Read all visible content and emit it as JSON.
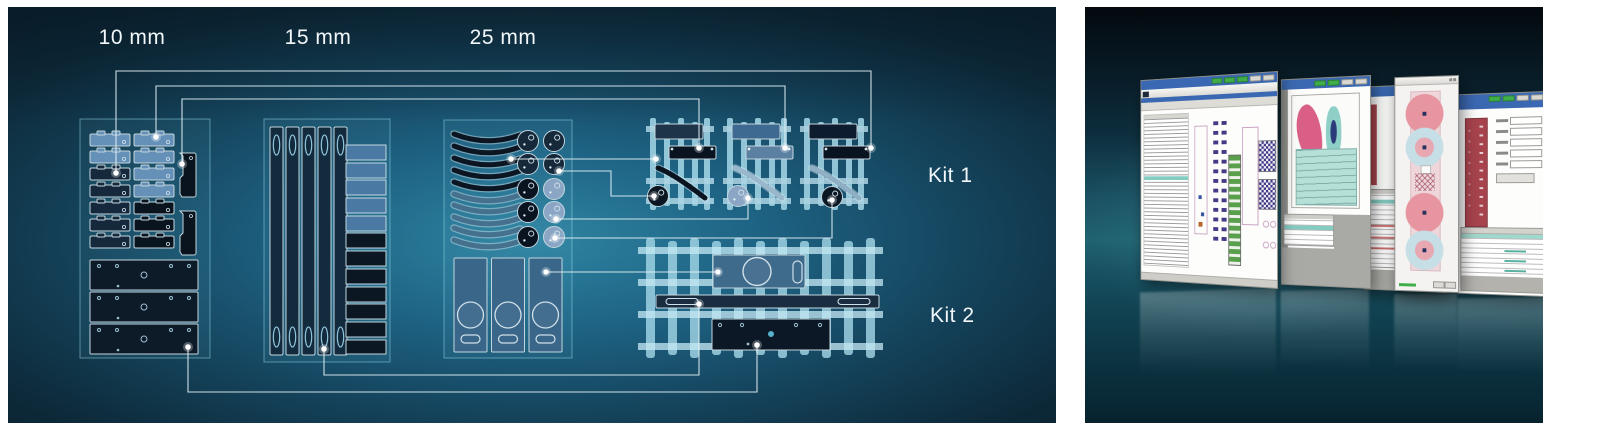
{
  "figure": {
    "left_panel": {
      "size_labels": [
        "10 mm",
        "15 mm",
        "25 mm"
      ],
      "kit_labels": [
        "Kit 1",
        "Kit 2"
      ],
      "groups": [
        {
          "name": "clip-parts-10mm",
          "clip_rows": 7,
          "clip_cols": 2,
          "side_brackets": 2,
          "bottom_plates": 3
        },
        {
          "name": "rail-parts-15mm",
          "rails": 5,
          "bars": 12,
          "light_bars": 5,
          "dark_bars": 7
        },
        {
          "name": "arc-disc-parts-25mm",
          "arcs": 10,
          "discs": 10,
          "panels": 3
        }
      ],
      "kits": [
        {
          "name": "kit-1",
          "assemblies": 3
        },
        {
          "name": "kit-2",
          "assemblies": 1
        }
      ],
      "connections": [
        {
          "from": "10mm-dark-clip",
          "to": "kit1-assembly-3-bar"
        },
        {
          "from": "10mm-light-clip",
          "to": "kit1-assembly-2-bar"
        },
        {
          "from": "10mm-bracket",
          "to": "kit1-assembly-1-bar"
        },
        {
          "from": "25mm-arc",
          "to": "kit1-assembly-1-arc"
        },
        {
          "from": "25mm-dark-disc",
          "to": "kit1-assembly-1-disc"
        },
        {
          "from": "25mm-light-disc",
          "to": "kit1-assembly-2-disc"
        },
        {
          "from": "25mm-light-disc-2",
          "to": "kit1-assembly-3-disc"
        },
        {
          "from": "25mm-panel",
          "to": "kit2-blue-plate"
        },
        {
          "from": "15mm-rail",
          "to": "kit2-long-bar"
        },
        {
          "from": "10mm-plate",
          "to": "kit2-dark-plate"
        }
      ],
      "colors": {
        "background_glow": "#2f84a2",
        "background_dark": "#0a2130",
        "piece_light": "#6590b8",
        "piece_navy": "#16293c",
        "piece_black": "#0a141f",
        "piece_steel": "#4a7aa4",
        "disc_light": "#8aa6c4",
        "panel_blue": "#3a6789",
        "frame_cyan": "#a5d8e8",
        "connector": "#e4f2f6",
        "outline": "#c2d6de",
        "label_text": "#f2f7f9"
      }
    },
    "right_panel": {
      "windows": [
        {
          "name": "cad-parts-list-window"
        },
        {
          "name": "shape-editor-window"
        },
        {
          "name": "table-window-with-chip-dialog"
        },
        {
          "name": "parameters-table-window"
        }
      ],
      "colors": {
        "menu_bar": "#3a68b2",
        "button_green": "#3fae49",
        "chrome": "#ecece9",
        "highlight_teal": "#9fd8cc",
        "accent_maroon": "#a8434c",
        "accent_pink": "#d95f87",
        "background_glow": "#20626f",
        "background_dark": "#04090e"
      }
    }
  }
}
